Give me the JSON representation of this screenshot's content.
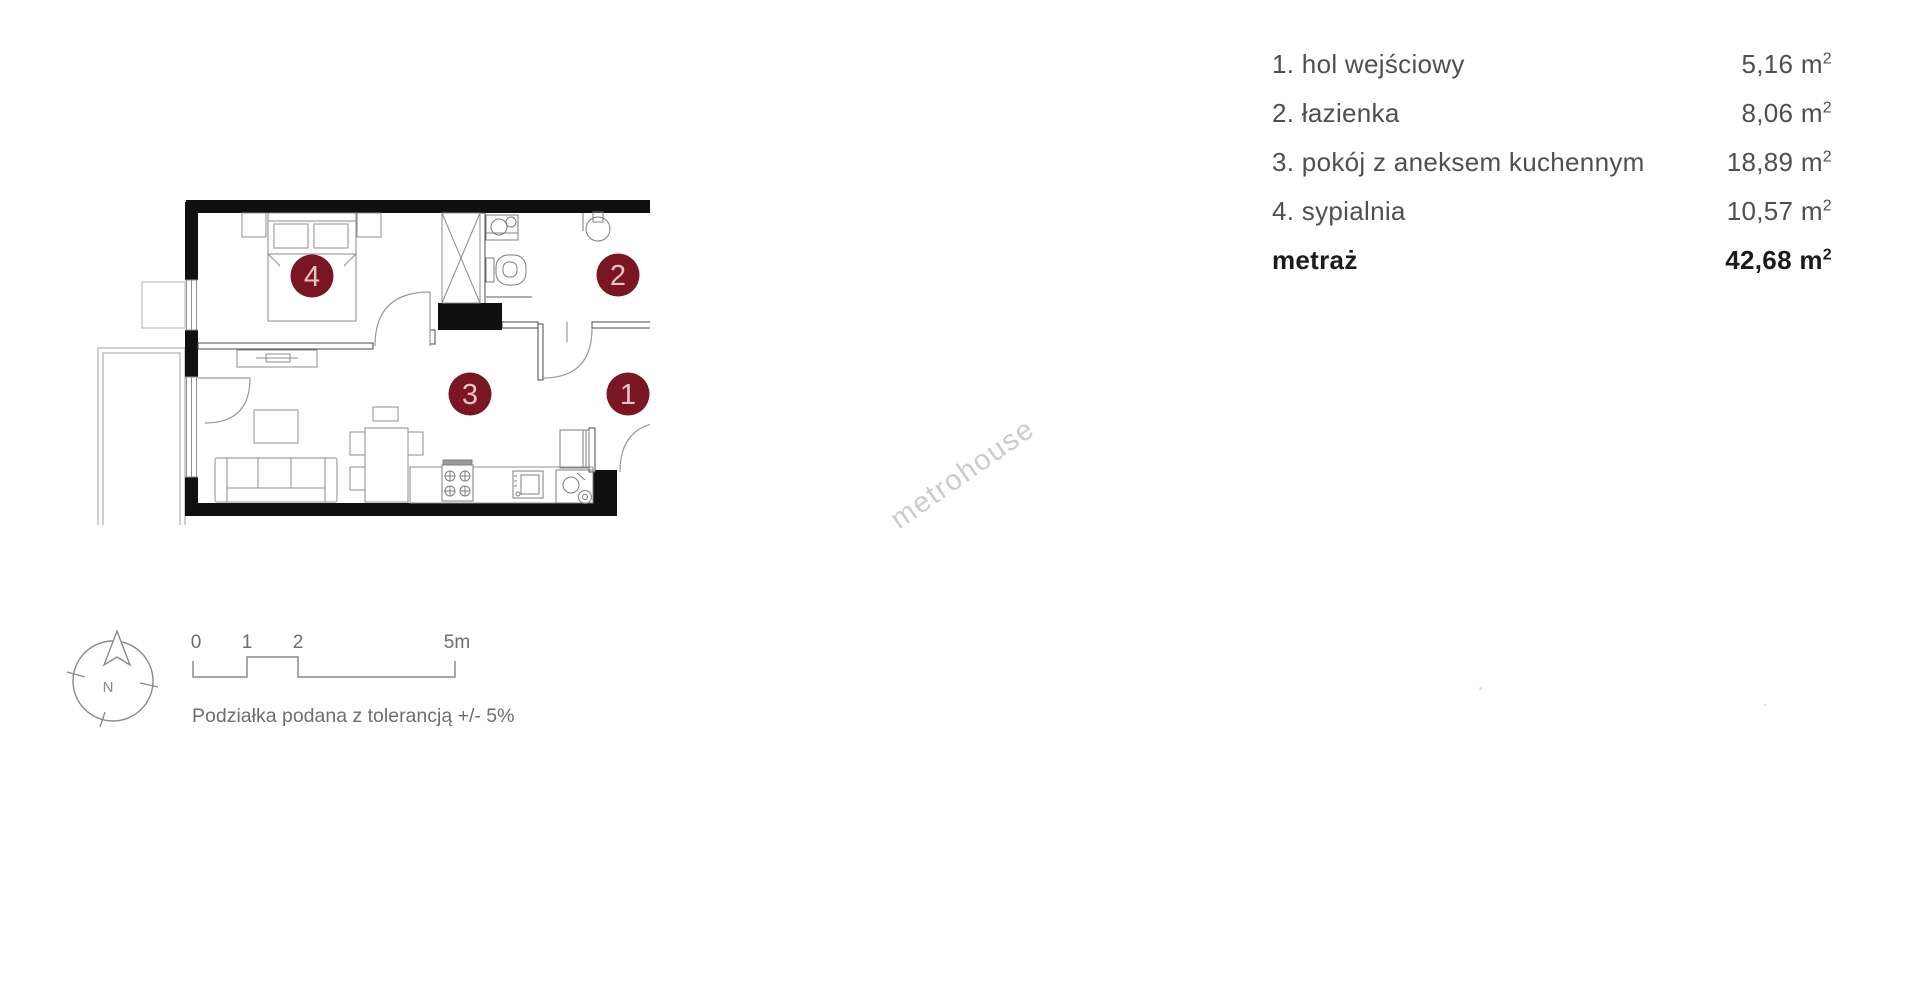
{
  "legend": {
    "unit_value": "m",
    "unit_sup": "2",
    "items": [
      {
        "label": "1. hol wejściowy",
        "area": "5,16"
      },
      {
        "label": "2. łazienka",
        "area": "8,06"
      },
      {
        "label": "3. pokój z aneksem kuchennym",
        "area": "18,89"
      },
      {
        "label": "4. sypialnia",
        "area": "10,57"
      }
    ],
    "total_label": "metraż",
    "total_area": "42,68"
  },
  "plan": {
    "marker_fill": "#7a1523",
    "marker_text_color": "#e6c3c8",
    "wall_color": "#101010",
    "markers": [
      {
        "num": "1"
      },
      {
        "num": "2"
      },
      {
        "num": "3"
      },
      {
        "num": "4"
      }
    ]
  },
  "compass": {
    "north_label": "N"
  },
  "scale_bar": {
    "labels": [
      "0",
      "1",
      "2",
      "5m"
    ],
    "caption": "Podziałka podana z tolerancją +/- 5%"
  },
  "watermark": {
    "text": "metrohouse"
  }
}
